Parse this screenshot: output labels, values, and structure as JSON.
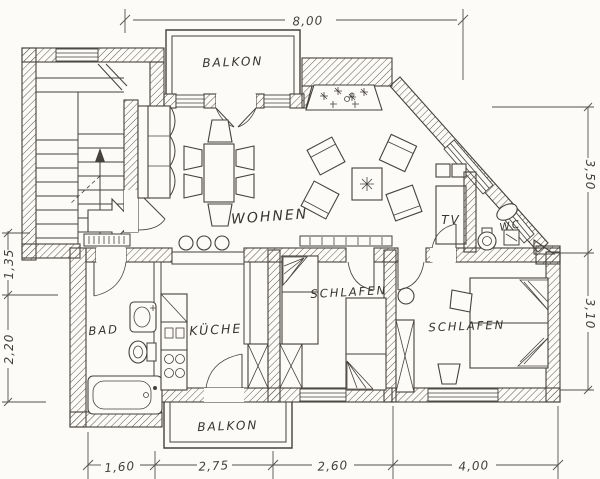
{
  "drawing_title": "apartment floor plan",
  "palette": {
    "paper": "#fcfbf8",
    "ink": "#45423d"
  },
  "rooms": {
    "balkon_top": "BALKON",
    "wohnen": "WOHNEN",
    "schlafen_mid": "SCHLAFEN",
    "schlafen_right": "SCHLAFEN",
    "kueche": "KÜCHE",
    "bad": "BAD",
    "wc": "WC",
    "tv": "TV",
    "balkon_bottom": "BALKON"
  },
  "dimensions": {
    "top_width": "8,00",
    "right_upper": "3,50",
    "right_lower": "3,10",
    "left_upper": "1,35",
    "left_lower": "2,20",
    "bottom_1": "1,60",
    "bottom_2": "2,75",
    "bottom_3": "2,60",
    "bottom_4": "4,00"
  }
}
